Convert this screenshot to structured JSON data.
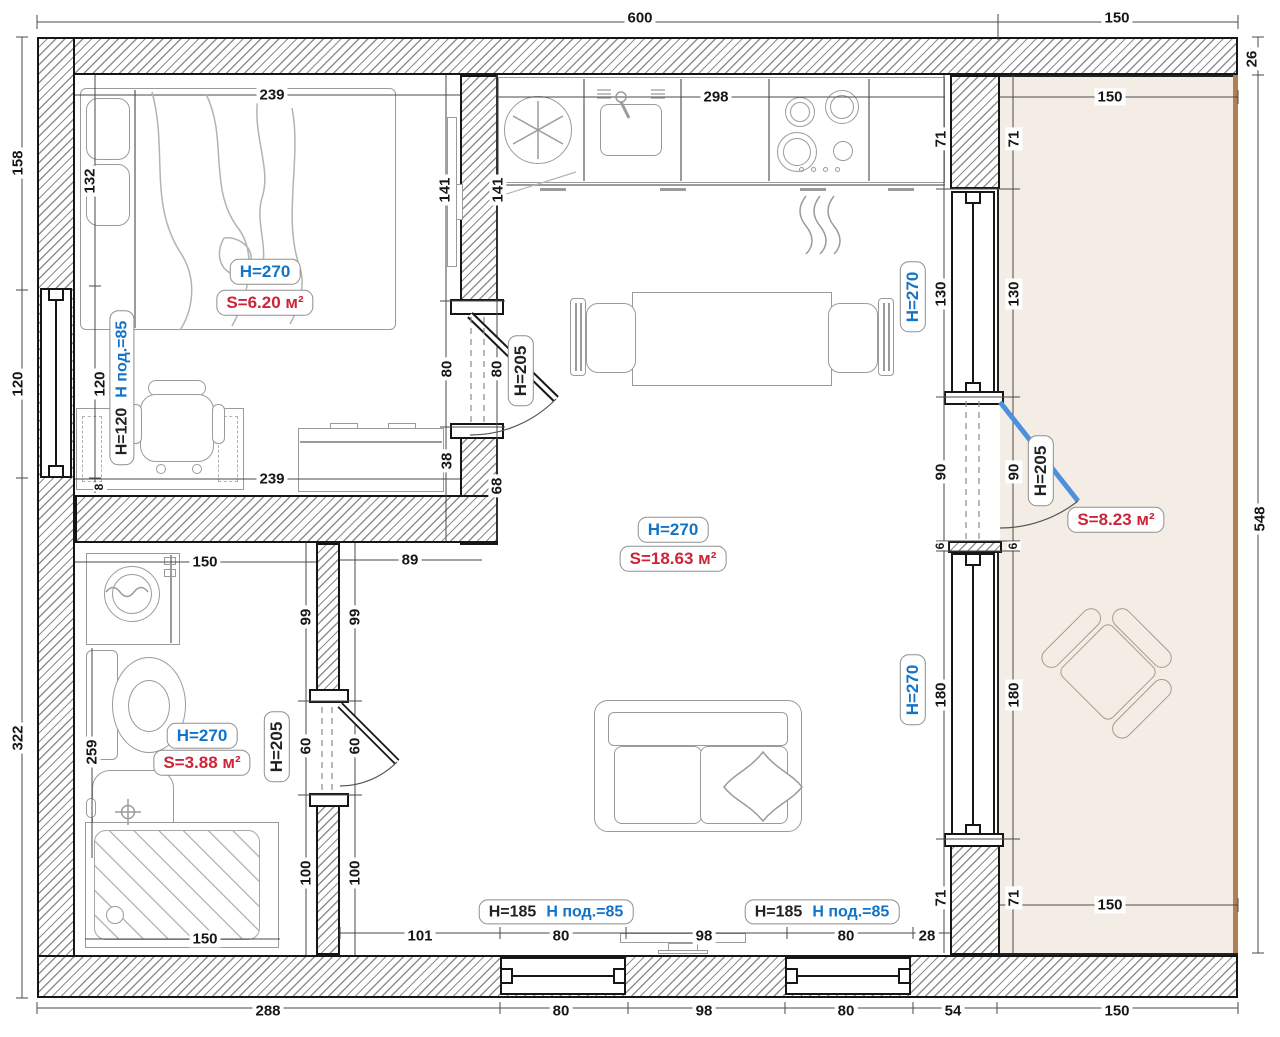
{
  "colors": {
    "accent_blue": "#1273c9",
    "accent_red": "#cd2438",
    "door_blue": "#4d90dd",
    "balcony_fill": "#f4ede6",
    "balcony_edge": "#b27f52"
  },
  "tags": {
    "bedroom_h": "H=270",
    "bedroom_s": "S=6.20 м²",
    "living_h": "H=270",
    "living_s": "S=18.63 м²",
    "bath_h": "H=270",
    "bath_s": "S=3.88 м²",
    "balcony_s": "S=8.23 м²",
    "door_bedroom": "H=205",
    "door_bath": "H=205",
    "door_balcony": "H=205",
    "wall_upper_h": "Н=270",
    "wall_lower_h": "Н=270",
    "win_bedroom_h": "H=120",
    "win_bedroom_sill": "Н под.=85",
    "win_b1_h": "H=185",
    "win_b1_sill": "Н под.=85",
    "win_b2_h": "H=185",
    "win_b2_sill": "Н под.=85"
  },
  "dims": [
    {
      "t": "600",
      "x": 640,
      "y": 18
    },
    {
      "t": "150",
      "x": 1117,
      "y": 18
    },
    {
      "t": "26",
      "x": 1252,
      "y": 59,
      "r": 1
    },
    {
      "t": "548",
      "x": 1260,
      "y": 519,
      "r": 1
    },
    {
      "t": "158",
      "x": 18,
      "y": 163,
      "r": 1
    },
    {
      "t": "120",
      "x": 18,
      "y": 384,
      "r": 1
    },
    {
      "t": "322",
      "x": 18,
      "y": 738,
      "r": 1
    },
    {
      "t": "288",
      "x": 268,
      "y": 1011
    },
    {
      "t": "80",
      "x": 561,
      "y": 1011
    },
    {
      "t": "98",
      "x": 704,
      "y": 1011
    },
    {
      "t": "80",
      "x": 846,
      "y": 1011
    },
    {
      "t": "54",
      "x": 953,
      "y": 1011
    },
    {
      "t": "150",
      "x": 1117,
      "y": 1011
    },
    {
      "t": "101",
      "x": 420,
      "y": 936
    },
    {
      "t": "80",
      "x": 561,
      "y": 936
    },
    {
      "t": "98",
      "x": 704,
      "y": 936
    },
    {
      "t": "80",
      "x": 846,
      "y": 936
    },
    {
      "t": "28",
      "x": 927,
      "y": 936
    },
    {
      "t": "239",
      "x": 272,
      "y": 95
    },
    {
      "t": "132",
      "x": 90,
      "y": 181,
      "r": 1
    },
    {
      "t": "120",
      "x": 100,
      "y": 384,
      "r": 1
    },
    {
      "t": "8",
      "x": 100,
      "y": 487,
      "r": 1,
      "s": 1
    },
    {
      "t": "239",
      "x": 272,
      "y": 479
    },
    {
      "t": "141",
      "x": 445,
      "y": 190,
      "r": 1
    },
    {
      "t": "141",
      "x": 498,
      "y": 190,
      "r": 1
    },
    {
      "t": "80",
      "x": 447,
      "y": 369,
      "r": 1
    },
    {
      "t": "80",
      "x": 497,
      "y": 369,
      "r": 1
    },
    {
      "t": "38",
      "x": 447,
      "y": 461,
      "r": 1
    },
    {
      "t": "68",
      "x": 497,
      "y": 486,
      "r": 1
    },
    {
      "t": "298",
      "x": 716,
      "y": 97
    },
    {
      "t": "71",
      "x": 941,
      "y": 139,
      "r": 1
    },
    {
      "t": "71",
      "x": 1014,
      "y": 139,
      "r": 1
    },
    {
      "t": "130",
      "x": 941,
      "y": 294,
      "r": 1
    },
    {
      "t": "130",
      "x": 1014,
      "y": 294,
      "r": 1
    },
    {
      "t": "90",
      "x": 941,
      "y": 472,
      "r": 1
    },
    {
      "t": "90",
      "x": 1014,
      "y": 472,
      "r": 1
    },
    {
      "t": "6",
      "x": 941,
      "y": 546,
      "r": 1,
      "s": 1
    },
    {
      "t": "6",
      "x": 1014,
      "y": 546,
      "r": 1,
      "s": 1
    },
    {
      "t": "180",
      "x": 941,
      "y": 695,
      "r": 1
    },
    {
      "t": "180",
      "x": 1014,
      "y": 695,
      "r": 1
    },
    {
      "t": "71",
      "x": 941,
      "y": 898,
      "r": 1
    },
    {
      "t": "71",
      "x": 1014,
      "y": 898,
      "r": 1
    },
    {
      "t": "150",
      "x": 1110,
      "y": 97
    },
    {
      "t": "150",
      "x": 1110,
      "y": 905
    },
    {
      "t": "150",
      "x": 205,
      "y": 562
    },
    {
      "t": "89",
      "x": 410,
      "y": 560
    },
    {
      "t": "99",
      "x": 306,
      "y": 617,
      "r": 1
    },
    {
      "t": "99",
      "x": 355,
      "y": 617,
      "r": 1
    },
    {
      "t": "60",
      "x": 306,
      "y": 746,
      "r": 1
    },
    {
      "t": "60",
      "x": 355,
      "y": 746,
      "r": 1
    },
    {
      "t": "100",
      "x": 306,
      "y": 873,
      "r": 1
    },
    {
      "t": "100",
      "x": 355,
      "y": 873,
      "r": 1
    },
    {
      "t": "259",
      "x": 92,
      "y": 752,
      "r": 1
    },
    {
      "t": "150",
      "x": 205,
      "y": 939
    }
  ]
}
